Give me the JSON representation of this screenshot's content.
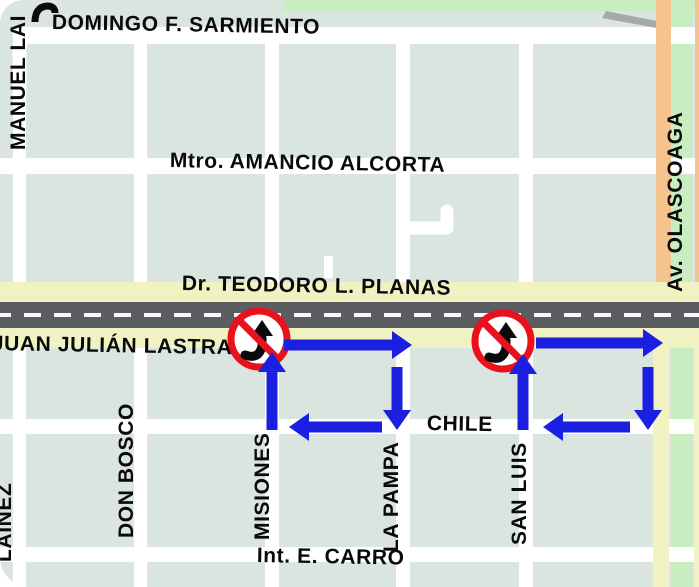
{
  "map": {
    "streets": {
      "horizontal": {
        "sarmiento": "DOMINGO F. SARMIENTO",
        "alcorta": "Mtro. AMANCIO ALCORTA",
        "planas": "Dr. TEODORO L. PLANAS",
        "lastra": "JUAN JULIÁN LASTRA",
        "chile": "CHILE",
        "carro": "Int. E. CARRO"
      },
      "vertical": {
        "manuel_lainez": "MANUEL LAI",
        "don_bosco": "DON BOSCO",
        "misiones": "MISIONES",
        "la_pampa": "LA PAMPA",
        "san_luis": "SAN LUIS",
        "lainez": "LAINEZ",
        "olascoaga": "Av. OLASCOAGA"
      }
    },
    "colors": {
      "block": "#dbe5e0",
      "street_white": "#ffffff",
      "avenue_orange": "#f5c38d",
      "street_yellow": "#f0f2c2",
      "green_strip": "#c7edc1",
      "road_gray": "#5c5d61",
      "dash_white": "#f7f7f7",
      "arrow_blue": "#1b1fdf",
      "sign_red": "#e8111c",
      "text_black": "#0a0a0a"
    },
    "arrows": [
      {
        "name": "arrow-misiones-up",
        "tail": [
          272,
          430
        ],
        "tip": [
          272,
          352
        ]
      },
      {
        "name": "arrow-lastra-right-west",
        "tail": [
          284,
          345
        ],
        "tip": [
          412,
          345
        ]
      },
      {
        "name": "arrow-la-pampa-down",
        "tail": [
          397,
          367
        ],
        "tip": [
          397,
          430
        ]
      },
      {
        "name": "arrow-chile-left-west",
        "tail": [
          382,
          427
        ],
        "tip": [
          289,
          427
        ]
      },
      {
        "name": "arrow-san-luis-up",
        "tail": [
          523,
          430
        ],
        "tip": [
          523,
          354
        ]
      },
      {
        "name": "arrow-lastra-right-east",
        "tail": [
          536,
          343
        ],
        "tip": [
          663,
          343
        ]
      },
      {
        "name": "arrow-east-street-down",
        "tail": [
          648,
          367
        ],
        "tip": [
          648,
          430
        ]
      },
      {
        "name": "arrow-chile-left-east",
        "tail": [
          630,
          427
        ],
        "tip": [
          543,
          427
        ]
      }
    ],
    "signs": {
      "type": "no-turn-prohibition",
      "positions": [
        [
          259,
          339
        ],
        [
          503,
          341
        ]
      ]
    }
  }
}
